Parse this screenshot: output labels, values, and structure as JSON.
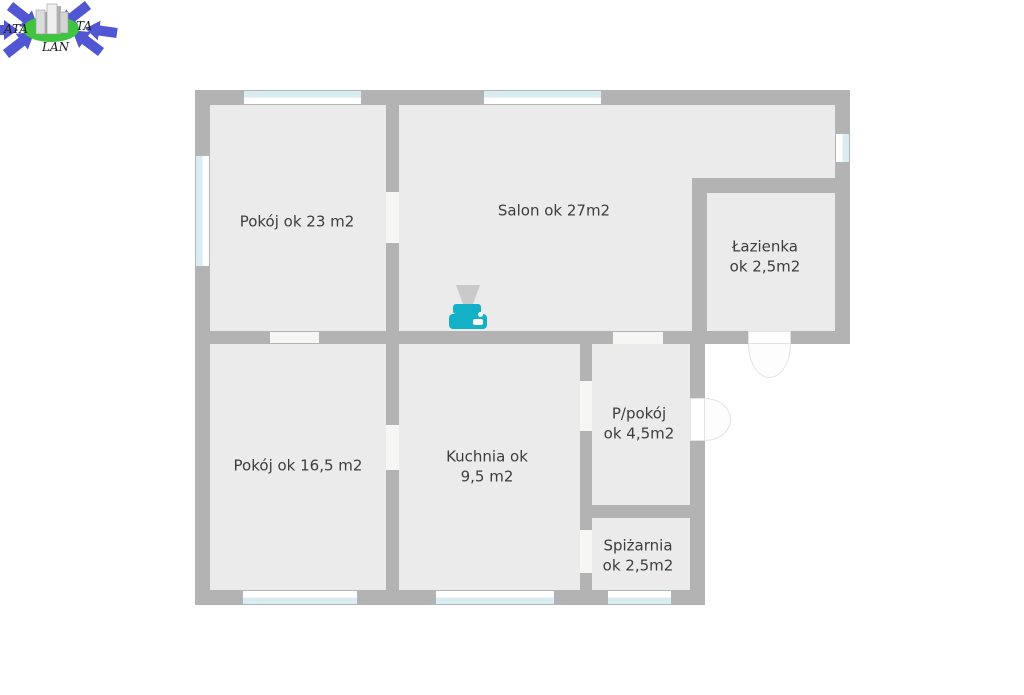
{
  "watermark": {
    "fragments": {
      "left": "ATA",
      "right": "TA",
      "bottom": "LAN"
    },
    "colors": {
      "arrows": "#5156d2",
      "globe": "#3ec43e",
      "buildings": "#c9c9c9",
      "text": "#1a1a1a"
    }
  },
  "floorplan": {
    "rooms": [
      {
        "id": "pokoj-23",
        "label": "Pokój ok 23 m2"
      },
      {
        "id": "salon",
        "label": "Salon ok 27m2"
      },
      {
        "id": "lazienka",
        "label": "Łazienka\nok 2,5m2"
      },
      {
        "id": "pokoj-16",
        "label": "Pokój ok 16,5 m2"
      },
      {
        "id": "kuchnia",
        "label": "Kuchnia ok\n9,5 m2"
      },
      {
        "id": "p-pokoj",
        "label": "P/pokój\nok 4,5m2"
      },
      {
        "id": "spizarnia",
        "label": "Spiżarnia\nok 2,5m2"
      }
    ],
    "icons": [
      {
        "name": "stove-icon",
        "color": "#12b1c8",
        "hood_color": "#cacaca"
      }
    ],
    "colors": {
      "wall": "#b3b3b3",
      "floor": "#ebebeb",
      "window_glass": "#d9ecf2",
      "door": "#ffffff",
      "label_text": "#3d3d3d"
    }
  }
}
